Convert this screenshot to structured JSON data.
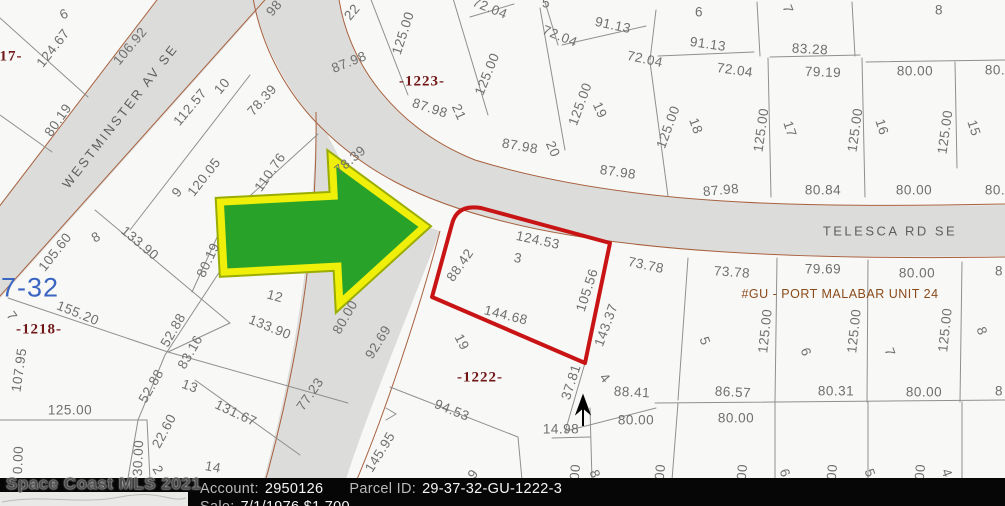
{
  "map": {
    "selected_parcel": {
      "lot": "3",
      "outline_color": "#c81414"
    },
    "arrow": {
      "fill": "#28a228",
      "outline": "#f0ef0a"
    },
    "labels": [
      {
        "t": "6",
        "x": 64,
        "y": 14,
        "r": -25,
        "k": "lot"
      },
      {
        "t": "124.67",
        "x": 53,
        "y": 48,
        "r": -52
      },
      {
        "t": "106.92",
        "x": 130,
        "y": 46,
        "r": -50
      },
      {
        "t": "80.19",
        "x": 58,
        "y": 120,
        "r": -55
      },
      {
        "t": "17-",
        "x": 11,
        "y": 57,
        "r": 0,
        "k": "block"
      },
      {
        "t": "98",
        "x": 274,
        "y": 8,
        "r": -50
      },
      {
        "t": "WESTMINSTER AV SE",
        "x": 120,
        "y": 116,
        "r": -52,
        "k": "street"
      },
      {
        "t": "112.57",
        "x": 190,
        "y": 107,
        "r": -50
      },
      {
        "t": "10",
        "x": 222,
        "y": 86,
        "r": -50,
        "k": "lot"
      },
      {
        "t": "78.39",
        "x": 262,
        "y": 100,
        "r": -48
      },
      {
        "t": "78.39",
        "x": 350,
        "y": 160,
        "r": -40
      },
      {
        "t": "120.05",
        "x": 204,
        "y": 177,
        "r": -52
      },
      {
        "t": "9",
        "x": 177,
        "y": 192,
        "r": -50,
        "k": "lot"
      },
      {
        "t": "110.76",
        "x": 270,
        "y": 172,
        "r": -55
      },
      {
        "t": "22",
        "x": 352,
        "y": 12,
        "r": -50,
        "k": "lot"
      },
      {
        "t": "125.00",
        "x": 403,
        "y": 33,
        "r": -72
      },
      {
        "t": "87.98",
        "x": 349,
        "y": 62,
        "r": -22
      },
      {
        "t": "-1223-",
        "x": 422,
        "y": 82,
        "r": 0,
        "k": "block"
      },
      {
        "t": "72.04",
        "x": 490,
        "y": 8,
        "r": 22
      },
      {
        "t": "87.98",
        "x": 430,
        "y": 108,
        "r": 18
      },
      {
        "t": "21",
        "x": 459,
        "y": 112,
        "r": 66,
        "k": "lot"
      },
      {
        "t": "125.00",
        "x": 487,
        "y": 74,
        "r": -68
      },
      {
        "t": "72.04",
        "x": 560,
        "y": 36,
        "r": 22
      },
      {
        "t": "91.13",
        "x": 613,
        "y": 25,
        "r": 12
      },
      {
        "t": "5",
        "x": 546,
        "y": 3,
        "r": 0,
        "k": "lot"
      },
      {
        "t": "72.04",
        "x": 645,
        "y": 59,
        "r": 12
      },
      {
        "t": "125.00",
        "x": 580,
        "y": 104,
        "r": -70
      },
      {
        "t": "19",
        "x": 600,
        "y": 110,
        "r": 66,
        "k": "lot"
      },
      {
        "t": "87.98",
        "x": 520,
        "y": 146,
        "r": 10
      },
      {
        "t": "20",
        "x": 553,
        "y": 149,
        "r": 66,
        "k": "lot"
      },
      {
        "t": "87.98",
        "x": 618,
        "y": 172,
        "r": 8
      },
      {
        "t": "6",
        "x": 699,
        "y": 12,
        "r": 0,
        "k": "lot"
      },
      {
        "t": "91.13",
        "x": 708,
        "y": 44,
        "r": 8
      },
      {
        "t": "7",
        "x": 788,
        "y": 9,
        "r": 70,
        "k": "lot"
      },
      {
        "t": "83.28",
        "x": 810,
        "y": 49,
        "r": 3
      },
      {
        "t": "8",
        "x": 939,
        "y": 10,
        "r": 0,
        "k": "lot"
      },
      {
        "t": "72.04",
        "x": 735,
        "y": 70,
        "r": 8
      },
      {
        "t": "79.19",
        "x": 823,
        "y": 72,
        "r": 2
      },
      {
        "t": "80.00",
        "x": 915,
        "y": 71,
        "r": 0
      },
      {
        "t": "80.",
        "x": 995,
        "y": 70,
        "r": 0
      },
      {
        "t": "125.00",
        "x": 668,
        "y": 127,
        "r": -70
      },
      {
        "t": "18",
        "x": 696,
        "y": 126,
        "r": 70,
        "k": "lot"
      },
      {
        "t": "125.00",
        "x": 761,
        "y": 130,
        "r": -82
      },
      {
        "t": "17",
        "x": 790,
        "y": 129,
        "r": 72,
        "k": "lot"
      },
      {
        "t": "125.00",
        "x": 855,
        "y": 130,
        "r": -82
      },
      {
        "t": "16",
        "x": 882,
        "y": 127,
        "r": 72,
        "k": "lot"
      },
      {
        "t": "125.00",
        "x": 945,
        "y": 132,
        "r": -82
      },
      {
        "t": "15",
        "x": 974,
        "y": 128,
        "r": 72,
        "k": "lot"
      },
      {
        "t": "87.98",
        "x": 721,
        "y": 190,
        "r": -5
      },
      {
        "t": "80.84",
        "x": 823,
        "y": 190,
        "r": 0
      },
      {
        "t": "80.00",
        "x": 914,
        "y": 190,
        "r": 0
      },
      {
        "t": "80.",
        "x": 995,
        "y": 190,
        "r": 0
      },
      {
        "t": "TELESCA RD SE",
        "x": 890,
        "y": 231,
        "r": 0,
        "k": "street"
      },
      {
        "t": "124.53",
        "x": 538,
        "y": 240,
        "r": 12
      },
      {
        "t": "3",
        "x": 518,
        "y": 258,
        "r": 10,
        "k": "lot"
      },
      {
        "t": "88.42",
        "x": 460,
        "y": 265,
        "r": -55
      },
      {
        "t": "144.68",
        "x": 506,
        "y": 315,
        "r": 14
      },
      {
        "t": "105.56",
        "x": 587,
        "y": 290,
        "r": -72
      },
      {
        "t": "143.37",
        "x": 606,
        "y": 325,
        "r": -70
      },
      {
        "t": "73.78",
        "x": 646,
        "y": 265,
        "r": 12
      },
      {
        "t": "73.78",
        "x": 732,
        "y": 272,
        "r": 4
      },
      {
        "t": "79.69",
        "x": 823,
        "y": 269,
        "r": 0
      },
      {
        "t": "80.00",
        "x": 917,
        "y": 273,
        "r": 0
      },
      {
        "t": "8",
        "x": 999,
        "y": 271,
        "r": 0
      },
      {
        "t": "#GU - PORT MALABAR UNIT 24",
        "x": 840,
        "y": 294,
        "r": 0,
        "k": "unit"
      },
      {
        "t": "125.00",
        "x": 765,
        "y": 331,
        "r": -84
      },
      {
        "t": "5",
        "x": 705,
        "y": 341,
        "r": 70,
        "k": "lot"
      },
      {
        "t": "125.00",
        "x": 854,
        "y": 331,
        "r": -84
      },
      {
        "t": "6",
        "x": 806,
        "y": 352,
        "r": 70,
        "k": "lot"
      },
      {
        "t": "125.00",
        "x": 945,
        "y": 330,
        "r": -84
      },
      {
        "t": "7",
        "x": 890,
        "y": 352,
        "r": 70,
        "k": "lot"
      },
      {
        "t": "8",
        "x": 982,
        "y": 331,
        "r": 70,
        "k": "lot"
      },
      {
        "t": "86.57",
        "x": 733,
        "y": 392,
        "r": 3
      },
      {
        "t": "80.31",
        "x": 836,
        "y": 391,
        "r": 0
      },
      {
        "t": "80.00",
        "x": 924,
        "y": 392,
        "r": 0
      },
      {
        "t": "8",
        "x": 999,
        "y": 391,
        "r": 0
      },
      {
        "t": "80.00",
        "x": 636,
        "y": 420,
        "r": 0
      },
      {
        "t": "80.00",
        "x": 736,
        "y": 418,
        "r": 0
      },
      {
        "t": "80.00",
        "x": 345,
        "y": 317,
        "r": -60
      },
      {
        "t": "92.69",
        "x": 378,
        "y": 342,
        "r": -58
      },
      {
        "t": "19",
        "x": 462,
        "y": 342,
        "r": 62,
        "k": "lot"
      },
      {
        "t": "-1222-",
        "x": 480,
        "y": 378,
        "r": 0,
        "k": "block"
      },
      {
        "t": "94.53",
        "x": 452,
        "y": 410,
        "r": 22
      },
      {
        "t": "145.95",
        "x": 380,
        "y": 452,
        "r": -58
      },
      {
        "t": "77.23",
        "x": 310,
        "y": 394,
        "r": -55
      },
      {
        "t": "37.81",
        "x": 571,
        "y": 382,
        "r": -72
      },
      {
        "t": "4",
        "x": 605,
        "y": 378,
        "r": 50,
        "k": "lot"
      },
      {
        "t": "88.41",
        "x": 632,
        "y": 392,
        "r": 3
      },
      {
        "t": "14.98",
        "x": 561,
        "y": 429,
        "r": 0
      },
      {
        "t": "7-32",
        "x": 30,
        "y": 288,
        "r": 0,
        "k": "blue"
      },
      {
        "t": "105.60",
        "x": 55,
        "y": 252,
        "r": -52
      },
      {
        "t": "8",
        "x": 96,
        "y": 237,
        "r": -30,
        "k": "lot"
      },
      {
        "t": "133.90",
        "x": 140,
        "y": 243,
        "r": 40
      },
      {
        "t": "80.19",
        "x": 208,
        "y": 260,
        "r": -65
      },
      {
        "t": "155.20",
        "x": 78,
        "y": 313,
        "r": 22
      },
      {
        "t": "7",
        "x": 12,
        "y": 316,
        "r": 55,
        "k": "lot"
      },
      {
        "t": "-1218-",
        "x": 39,
        "y": 330,
        "r": 0,
        "k": "block"
      },
      {
        "t": "107.95",
        "x": 19,
        "y": 370,
        "r": -82
      },
      {
        "t": "12",
        "x": 275,
        "y": 296,
        "r": 15,
        "k": "lot"
      },
      {
        "t": "133.90",
        "x": 270,
        "y": 327,
        "r": 22
      },
      {
        "t": "52.88",
        "x": 173,
        "y": 330,
        "r": -60
      },
      {
        "t": "83.16",
        "x": 190,
        "y": 352,
        "r": -60
      },
      {
        "t": "52.88",
        "x": 151,
        "y": 386,
        "r": -60
      },
      {
        "t": "13",
        "x": 190,
        "y": 386,
        "r": 20,
        "k": "lot"
      },
      {
        "t": "131.67",
        "x": 236,
        "y": 413,
        "r": 25
      },
      {
        "t": "22.60",
        "x": 164,
        "y": 431,
        "r": -62
      },
      {
        "t": "125.00",
        "x": 70,
        "y": 410,
        "r": 0
      },
      {
        "t": "14",
        "x": 213,
        "y": 467,
        "r": 10,
        "k": "lot"
      },
      {
        "t": "2",
        "x": 158,
        "y": 470,
        "r": 60,
        "k": "lot"
      },
      {
        "t": "0.00",
        "x": 18,
        "y": 460,
        "r": -88
      },
      {
        "t": "30.00",
        "x": 138,
        "y": 458,
        "r": -88
      },
      {
        "t": "9",
        "x": 473,
        "y": 474,
        "r": -55,
        "k": "lot"
      },
      {
        "t": "00",
        "x": 575,
        "y": 472,
        "r": -85
      },
      {
        "t": "8",
        "x": 595,
        "y": 474,
        "r": 70,
        "k": "lot"
      },
      {
        "t": "00",
        "x": 660,
        "y": 472,
        "r": -85
      },
      {
        "t": "00",
        "x": 742,
        "y": 472,
        "r": -85
      },
      {
        "t": "6",
        "x": 785,
        "y": 473,
        "r": 70,
        "k": "lot"
      },
      {
        "t": "00",
        "x": 832,
        "y": 472,
        "r": -85
      },
      {
        "t": "5",
        "x": 870,
        "y": 473,
        "r": 70,
        "k": "lot"
      },
      {
        "t": "00",
        "x": 920,
        "y": 472,
        "r": -85
      },
      {
        "t": "4",
        "x": 947,
        "y": 473,
        "r": 70,
        "k": "lot"
      }
    ]
  },
  "footer": {
    "watermark": "Space Coast MLS 2021",
    "account_label": "Account:",
    "account_value": "2950126",
    "parcel_label": "Parcel ID:",
    "parcel_value": "29-37-32-GU-1222-3",
    "sale_label": "Sale:",
    "sale_value": "7/1/1976 $1,700"
  }
}
